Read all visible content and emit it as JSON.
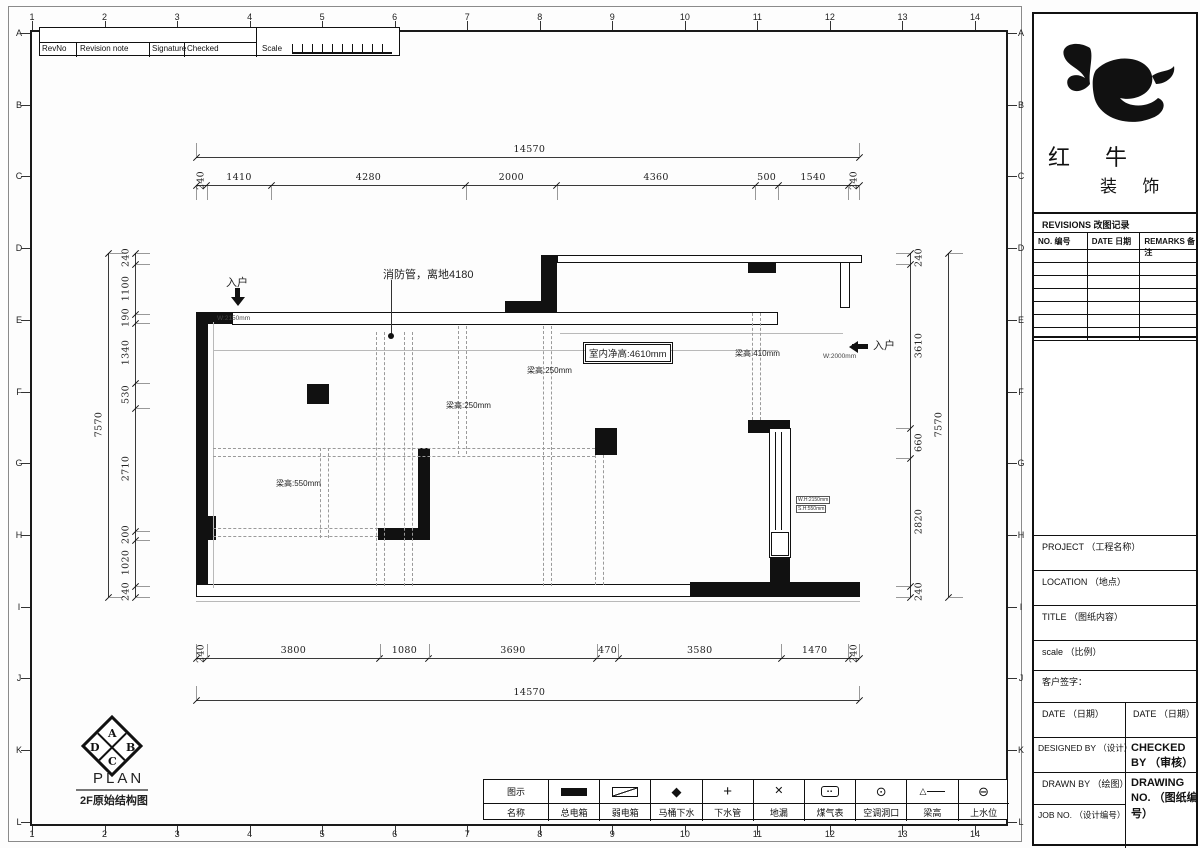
{
  "sheet": {
    "grid_columns": [
      "1",
      "2",
      "3",
      "4",
      "5",
      "6",
      "7",
      "8",
      "9",
      "10",
      "11",
      "12",
      "13",
      "14"
    ],
    "grid_rows": [
      "A",
      "B",
      "C",
      "D",
      "E",
      "F",
      "G",
      "H",
      "I",
      "J",
      "K",
      "L"
    ]
  },
  "revision_strip": {
    "rev_no": "RevNo",
    "revision_note": "Revision note",
    "signature": "Signature",
    "checked": "Checked",
    "scale": "Scale"
  },
  "brand": {
    "name_top": "红 牛",
    "name_bottom": "装 饰"
  },
  "revisions_panel": {
    "title": "REVISIONS 改图记录",
    "headers": [
      "NO. 编号",
      "DATE 日期",
      "REMARKS 备注"
    ],
    "empty_row_count": 7
  },
  "title_fields": [
    "PROJECT （工程名称）",
    "LOCATION （地点）",
    "TITLE （图纸内容）",
    "scale （比例）",
    "客户签字："
  ],
  "title_pairs": {
    "date_left": "DATE （日期）",
    "date_right": "DATE （日期）",
    "designed_by": "DESIGNED BY （设计）",
    "checked_by": "CHECKED BY （审核）",
    "drawn_by": "DRAWN BY （绘图）",
    "drawing_no": "DRAWING NO. （图纸编号）",
    "job_no": "JOB NO. （设计编号）"
  },
  "plan_block": {
    "compass_letters": [
      "A",
      "B",
      "C",
      "D"
    ],
    "title": "PLAN",
    "subtitle": "2F原始结构图"
  },
  "dimensions": {
    "top_total": "14570",
    "top_segments": [
      "240",
      "1410",
      "4280",
      "2000",
      "4360",
      "500",
      "1540",
      "240"
    ],
    "bottom_total": "14570",
    "bottom_segments": [
      "240",
      "3800",
      "1080",
      "3690",
      "470",
      "3580",
      "1470",
      "240"
    ],
    "left_total": "7570",
    "left_segments": [
      "240",
      "1100",
      "190",
      "1340",
      "530",
      "2710",
      "200",
      "1020",
      "240"
    ],
    "right_total": "7570",
    "right_segments": [
      "240",
      "3610",
      "660",
      "2820",
      "240"
    ]
  },
  "annotations": {
    "fire_pipe": "消防管，离地4180",
    "ceiling_height": "室内净高:4610mm",
    "beam_250_a": "梁高:250mm",
    "beam_250_b": "梁高:250mm",
    "beam_410": "梁高:410mm",
    "beam_550": "梁高:550mm",
    "entry_left": "入户",
    "entry_left_width": "W:2150mm",
    "entry_right": "入户",
    "entry_right_width": "W:2000mm",
    "window_label_1": "W.H:2150mm",
    "window_label_2": "S.H:550mm"
  },
  "legend": {
    "col_header_top": "图示",
    "col_header_bottom": "名称",
    "items": [
      {
        "name": "总电箱",
        "icon": "main-electric-box-icon"
      },
      {
        "name": "弱电箱",
        "icon": "weak-electric-box-icon"
      },
      {
        "name": "马桶下水",
        "icon": "toilet-drain-icon"
      },
      {
        "name": "下水管",
        "icon": "drain-pipe-icon"
      },
      {
        "name": "地漏",
        "icon": "floor-drain-icon"
      },
      {
        "name": "煤气表",
        "icon": "gas-meter-icon"
      },
      {
        "name": "空调洞口",
        "icon": "ac-opening-icon"
      },
      {
        "name": "梁高",
        "icon": "beam-height-icon"
      },
      {
        "name": "上水位",
        "icon": "water-supply-icon"
      }
    ]
  }
}
